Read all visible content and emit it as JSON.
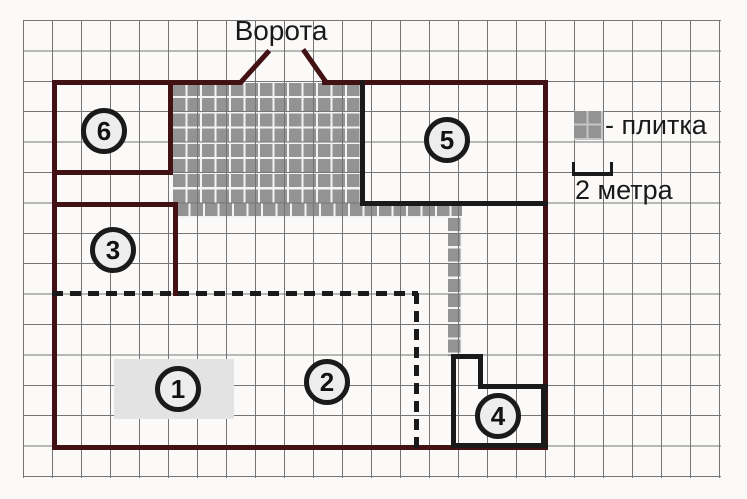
{
  "plan": {
    "gate_label": "Ворота",
    "regions": [
      {
        "id": 1,
        "label": "1"
      },
      {
        "id": 2,
        "label": "2"
      },
      {
        "id": 3,
        "label": "3"
      },
      {
        "id": 4,
        "label": "4"
      },
      {
        "id": 5,
        "label": "5"
      },
      {
        "id": 6,
        "label": "6"
      }
    ]
  },
  "legend": {
    "tile_label": "- плитка",
    "scale_label": "2 метра"
  },
  "colors": {
    "paper": "#fbfaf8",
    "grid-line": "#757575",
    "plot-border": "#421114",
    "line-black": "#1a1a1a",
    "tile": "#939393",
    "tile-gap": "#f3f3f3",
    "tile-icon-gap": "#c6c6c6",
    "region1-fill": "#e3e3e3",
    "circle-fill": "#ededed"
  }
}
